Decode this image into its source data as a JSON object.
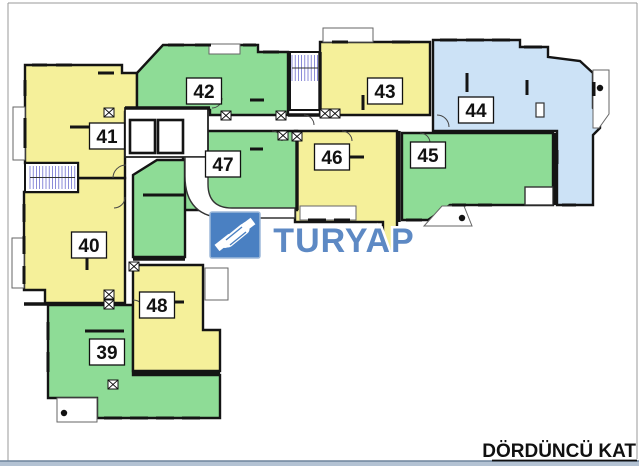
{
  "title": {
    "text": "DÖRDÜNCÜ KAT"
  },
  "logo": {
    "text": "TURYAP",
    "icon": "handshake-icon",
    "square_color": "#4A80C2",
    "square_edge": "#9DB9DA",
    "text_color": "#5D89C4",
    "square": [
      210,
      212,
      50,
      46
    ]
  },
  "floor_plan": {
    "colors": {
      "yellow": "#F5F09A",
      "green": "#8EDC96",
      "blue": "#CCE2F6",
      "wall": "#141414",
      "hatch": "#5A5AC8",
      "bar": "#B3C2D3",
      "bar_edge": "#6E849C"
    },
    "rooms": [
      {
        "number": "39",
        "color": "green",
        "points": "48,305 133,305 133,375 220,375 220,418 97,418 97,398 48,398",
        "label": [
          107,
          352
        ]
      },
      {
        "number": "40",
        "color": "yellow",
        "points": "24,192 78,192 78,178 125,178 125,303 45,303 45,290 24,290",
        "label": [
          89,
          245
        ]
      },
      {
        "number": "41",
        "color": "yellow",
        "points": "25,65 122,65 122,73 137,73 137,112 125,112 125,178 78,178 78,163 25,163",
        "label": [
          107,
          136
        ]
      },
      {
        "number": "42",
        "color": "green",
        "points": "137,73 163,45 258,45 258,52 288,52 288,115 210,115 210,110 137,110",
        "label": [
          204,
          91
        ]
      },
      {
        "number": "43",
        "color": "yellow",
        "points": "320,42 430,42 430,115 320,115",
        "label": [
          385,
          91
        ]
      },
      {
        "number": "44",
        "color": "blue",
        "points": "433,40 520,40 520,47 548,47 548,57 580,61 593,73 593,108 600,116 600,128 593,135 593,205 557,205 557,131 433,131",
        "label": [
          476,
          110
        ]
      },
      {
        "number": "45",
        "color": "green",
        "points": "402,133 553,133 553,205 450,205 428,220 402,220",
        "label": [
          428,
          155
        ]
      },
      {
        "number": "46",
        "color": "yellow",
        "points": "295,131 397,131 397,250 383,250 383,222 295,222",
        "label": [
          332,
          157
        ]
      },
      {
        "number": "47",
        "color": "green",
        "points": "183,131 297,131 297,210 183,210",
        "label": [
          223,
          164
        ]
      },
      {
        "number": "47b",
        "color": "green",
        "points": "133,175 157,160 185,160 185,257 133,257",
        "label": null
      },
      {
        "number": "48",
        "color": "yellow",
        "points": "133,265 203,265 203,330 220,330 220,371 133,371",
        "label": [
          157,
          305
        ]
      }
    ],
    "white_shapes": [
      {
        "shape": "rect",
        "x": 25,
        "y": 163,
        "w": 53,
        "h": 29,
        "sw": 2,
        "sc": "#141414",
        "name": "stairwell-west"
      },
      {
        "shape": "rect",
        "x": 290,
        "y": 52,
        "w": 30,
        "h": 58,
        "sw": 2,
        "sc": "#141414",
        "name": "stairwell-north"
      },
      {
        "shape": "rect",
        "x": 125,
        "y": 108,
        "w": 83,
        "h": 49,
        "sw": 1.8,
        "sc": "#222222",
        "name": "elevator-hall"
      },
      {
        "shape": "path",
        "d": "M185,157 L208,157 L208,184 Q208,208 232,208 L295,208 L295,218 L227,218 Q185,218 185,176 Z",
        "sw": 1.4,
        "sc": "#333333",
        "name": "corridor"
      },
      {
        "shape": "rect",
        "x": 13,
        "y": 107,
        "w": 12,
        "h": 53,
        "sw": 1,
        "sc": "#666666",
        "name": "balcony-41"
      },
      {
        "shape": "rect",
        "x": 12,
        "y": 238,
        "w": 12,
        "h": 50,
        "sw": 1,
        "sc": "#666666",
        "name": "balcony-40"
      },
      {
        "shape": "rect",
        "x": 205,
        "y": 268,
        "w": 23,
        "h": 32,
        "sw": 1,
        "sc": "#666666",
        "name": "balcony-48"
      },
      {
        "shape": "rect",
        "x": 57,
        "y": 398,
        "w": 40,
        "h": 24,
        "sw": 1,
        "sc": "#666666",
        "name": "balcony-39"
      },
      {
        "shape": "path",
        "d": "M593,70 L609,70 L609,114 L599,128 L593,128 Z",
        "sw": 1,
        "sc": "#666666",
        "name": "balcony-44"
      },
      {
        "shape": "path",
        "d": "M424,226 L472,226 L464,206 L442,206 Z",
        "sw": 1,
        "sc": "#666666",
        "name": "balcony-45"
      },
      {
        "shape": "rect",
        "x": 323,
        "y": 28,
        "w": 50,
        "h": 14,
        "sw": 1,
        "sc": "#666666",
        "name": "balcony-43"
      },
      {
        "shape": "rect",
        "x": 209,
        "y": 44,
        "w": 31,
        "h": 10,
        "sw": 1,
        "sc": "#666666",
        "name": "balcony-42"
      },
      {
        "shape": "rect",
        "x": 300,
        "y": 206,
        "w": 56,
        "h": 14,
        "sw": 1,
        "sc": "#666666",
        "name": "balcony-46"
      },
      {
        "shape": "rect",
        "x": 525,
        "y": 187,
        "w": 28,
        "h": 18,
        "sw": 1.4,
        "sc": "#333333",
        "name": "terrace-45"
      },
      {
        "shape": "rect",
        "x": 536,
        "y": 103,
        "w": 8,
        "h": 14,
        "sw": 1.2,
        "sc": "#333333",
        "name": "duct-44"
      }
    ],
    "elevators": [
      [
        130,
        120,
        25,
        33
      ],
      [
        158,
        120,
        25,
        33
      ]
    ],
    "stairs": [
      {
        "x": 30,
        "y": 166,
        "w": 45,
        "h": 23
      },
      {
        "x": 292,
        "y": 55,
        "w": 26,
        "h": 26
      }
    ],
    "walls": [
      [
        125,
        108,
        210,
        108
      ],
      [
        288,
        115,
        320,
        115
      ],
      [
        320,
        52,
        320,
        110
      ],
      [
        399,
        131,
        399,
        222
      ],
      [
        555,
        133,
        555,
        205
      ],
      [
        133,
        259,
        185,
        259
      ],
      [
        24,
        304,
        125,
        304
      ],
      [
        133,
        373,
        220,
        373
      ],
      [
        297,
        131,
        297,
        210
      ]
    ],
    "windows": [
      [
        32,
        65,
        47,
        65
      ],
      [
        56,
        65,
        72,
        65
      ],
      [
        98,
        73,
        114,
        73
      ],
      [
        25,
        80,
        25,
        96
      ],
      [
        25,
        118,
        25,
        148
      ],
      [
        168,
        45,
        184,
        45
      ],
      [
        195,
        45,
        211,
        45
      ],
      [
        243,
        45,
        256,
        45
      ],
      [
        263,
        52,
        279,
        52
      ],
      [
        332,
        42,
        348,
        42
      ],
      [
        392,
        42,
        410,
        42
      ],
      [
        440,
        40,
        457,
        40
      ],
      [
        466,
        40,
        484,
        40
      ],
      [
        492,
        40,
        510,
        40
      ],
      [
        524,
        47,
        542,
        47
      ],
      [
        594,
        82,
        594,
        96
      ],
      [
        557,
        150,
        557,
        164
      ],
      [
        562,
        205,
        576,
        205
      ],
      [
        452,
        205,
        466,
        205
      ],
      [
        478,
        205,
        492,
        205
      ],
      [
        406,
        220,
        422,
        220
      ],
      [
        308,
        220,
        326,
        220
      ],
      [
        334,
        220,
        350,
        220
      ],
      [
        24,
        204,
        24,
        222
      ],
      [
        24,
        236,
        24,
        254
      ],
      [
        24,
        266,
        24,
        284
      ],
      [
        48,
        322,
        48,
        340
      ],
      [
        48,
        352,
        48,
        372
      ],
      [
        104,
        418,
        122,
        418
      ],
      [
        130,
        418,
        148,
        418
      ],
      [
        156,
        418,
        174,
        418
      ],
      [
        182,
        418,
        200,
        418
      ]
    ],
    "stubs": [
      [
        70,
        127,
        90,
        127
      ],
      [
        218,
        78,
        218,
        98
      ],
      [
        250,
        100,
        264,
        100
      ],
      [
        363,
        95,
        363,
        110
      ],
      [
        467,
        73,
        467,
        92
      ],
      [
        527,
        80,
        527,
        95
      ],
      [
        348,
        157,
        364,
        157
      ],
      [
        250,
        149,
        263,
        149
      ],
      [
        87,
        253,
        87,
        270
      ],
      [
        85,
        331,
        124,
        331
      ],
      [
        170,
        302,
        184,
        302
      ],
      [
        143,
        195,
        185,
        195
      ]
    ],
    "door_arcs": [
      "M113,178 A13,13 0 0 1 126,165",
      "M133,300 A12,12 0 0 1 145,312",
      "M437,115 A12,12 0 0 1 449,127",
      "M272,131 A10,10 0 0 1 282,141",
      "M342,131 A10,10 0 0 1 352,141",
      "M420,133 A10,10 0 0 1 430,143",
      "M212,108 A10,10 0 0 0 222,98",
      "M125,197 A11,11 0 0 1 114,208",
      "M304,115 A10,10 0 0 1 314,125"
    ],
    "shafts": [
      [
        104,
        108
      ],
      [
        221,
        111
      ],
      [
        276,
        111
      ],
      [
        278,
        131
      ],
      [
        292,
        132
      ],
      [
        320,
        109
      ],
      [
        330,
        109
      ],
      [
        129,
        262
      ],
      [
        104,
        290
      ],
      [
        104,
        300
      ],
      [
        108,
        380
      ]
    ],
    "columns": [
      [
        600,
        88
      ],
      [
        462,
        218
      ],
      [
        64,
        413
      ]
    ],
    "frame": [
      [
        8,
        3,
        8,
        461
      ],
      [
        8,
        3,
        637,
        3
      ],
      [
        637,
        3,
        637,
        459
      ]
    ]
  }
}
